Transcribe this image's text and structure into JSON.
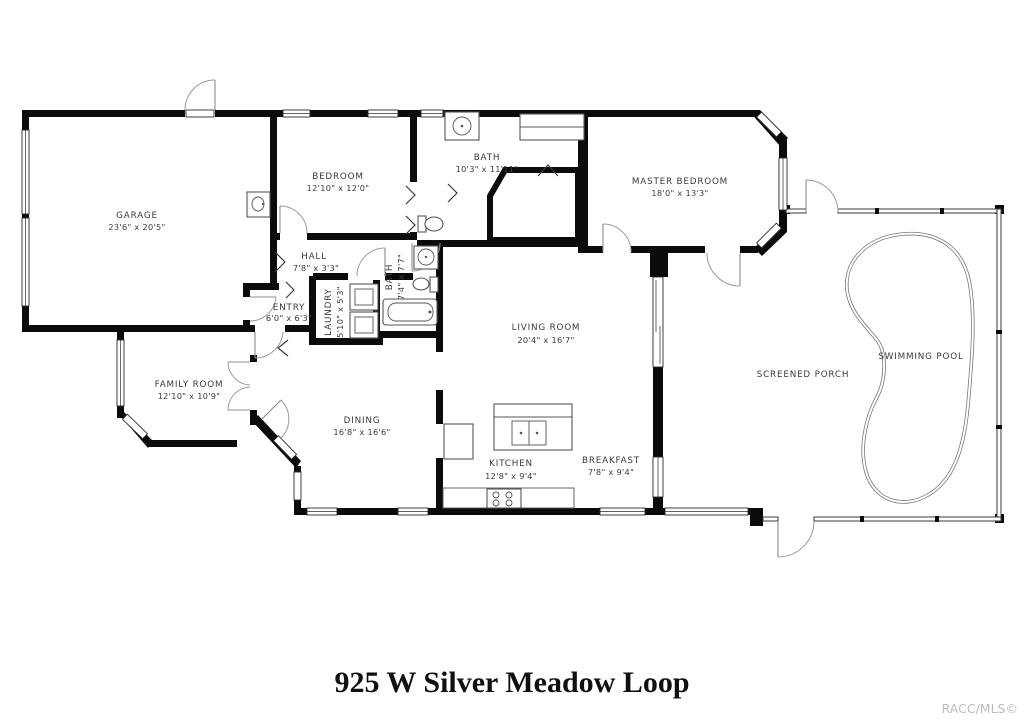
{
  "title": "925 W Silver Meadow Loop",
  "watermark": "RACC/MLS©",
  "colors": {
    "walls": "#0b0b0b",
    "labels": "#3a3a3a",
    "fixtures": "#555555",
    "watermark": "#bdbdbd"
  },
  "rooms": {
    "garage": {
      "name": "GARAGE",
      "dims": "23'6\" x 20'5\""
    },
    "bedroom": {
      "name": "BEDROOM",
      "dims": "12'10\" x 12'0\""
    },
    "bath_main": {
      "name": "BATH",
      "dims": "10'3\" x 11'11\""
    },
    "master_bedroom": {
      "name": "MASTER BEDROOM",
      "dims": "18'0\" x 13'3\""
    },
    "hall": {
      "name": "HALL",
      "dims": "7'8\" x 3'3\""
    },
    "entry": {
      "name": "ENTRY",
      "dims": "6'0\" x 6'3\""
    },
    "laundry": {
      "name": "LAUNDRY",
      "dims": "5'10\" x 5'3\""
    },
    "bath_small": {
      "name": "BATH",
      "dims": "7'4\" x 7'7\""
    },
    "living_room": {
      "name": "LIVING ROOM",
      "dims": "20'4\" x 16'7\""
    },
    "family_room": {
      "name": "FAMILY ROOM",
      "dims": "12'10\" x 10'9\""
    },
    "dining": {
      "name": "DINING",
      "dims": "16'8\" x 16'6\""
    },
    "kitchen": {
      "name": "KITCHEN",
      "dims": "12'8\" x 9'4\""
    },
    "breakfast": {
      "name": "BREAKFAST",
      "dims": "7'8\" x 9'4\""
    },
    "screened_porch": {
      "name": "SCREENED PORCH"
    },
    "swimming_pool": {
      "name": "SWIMMING POOL"
    }
  }
}
